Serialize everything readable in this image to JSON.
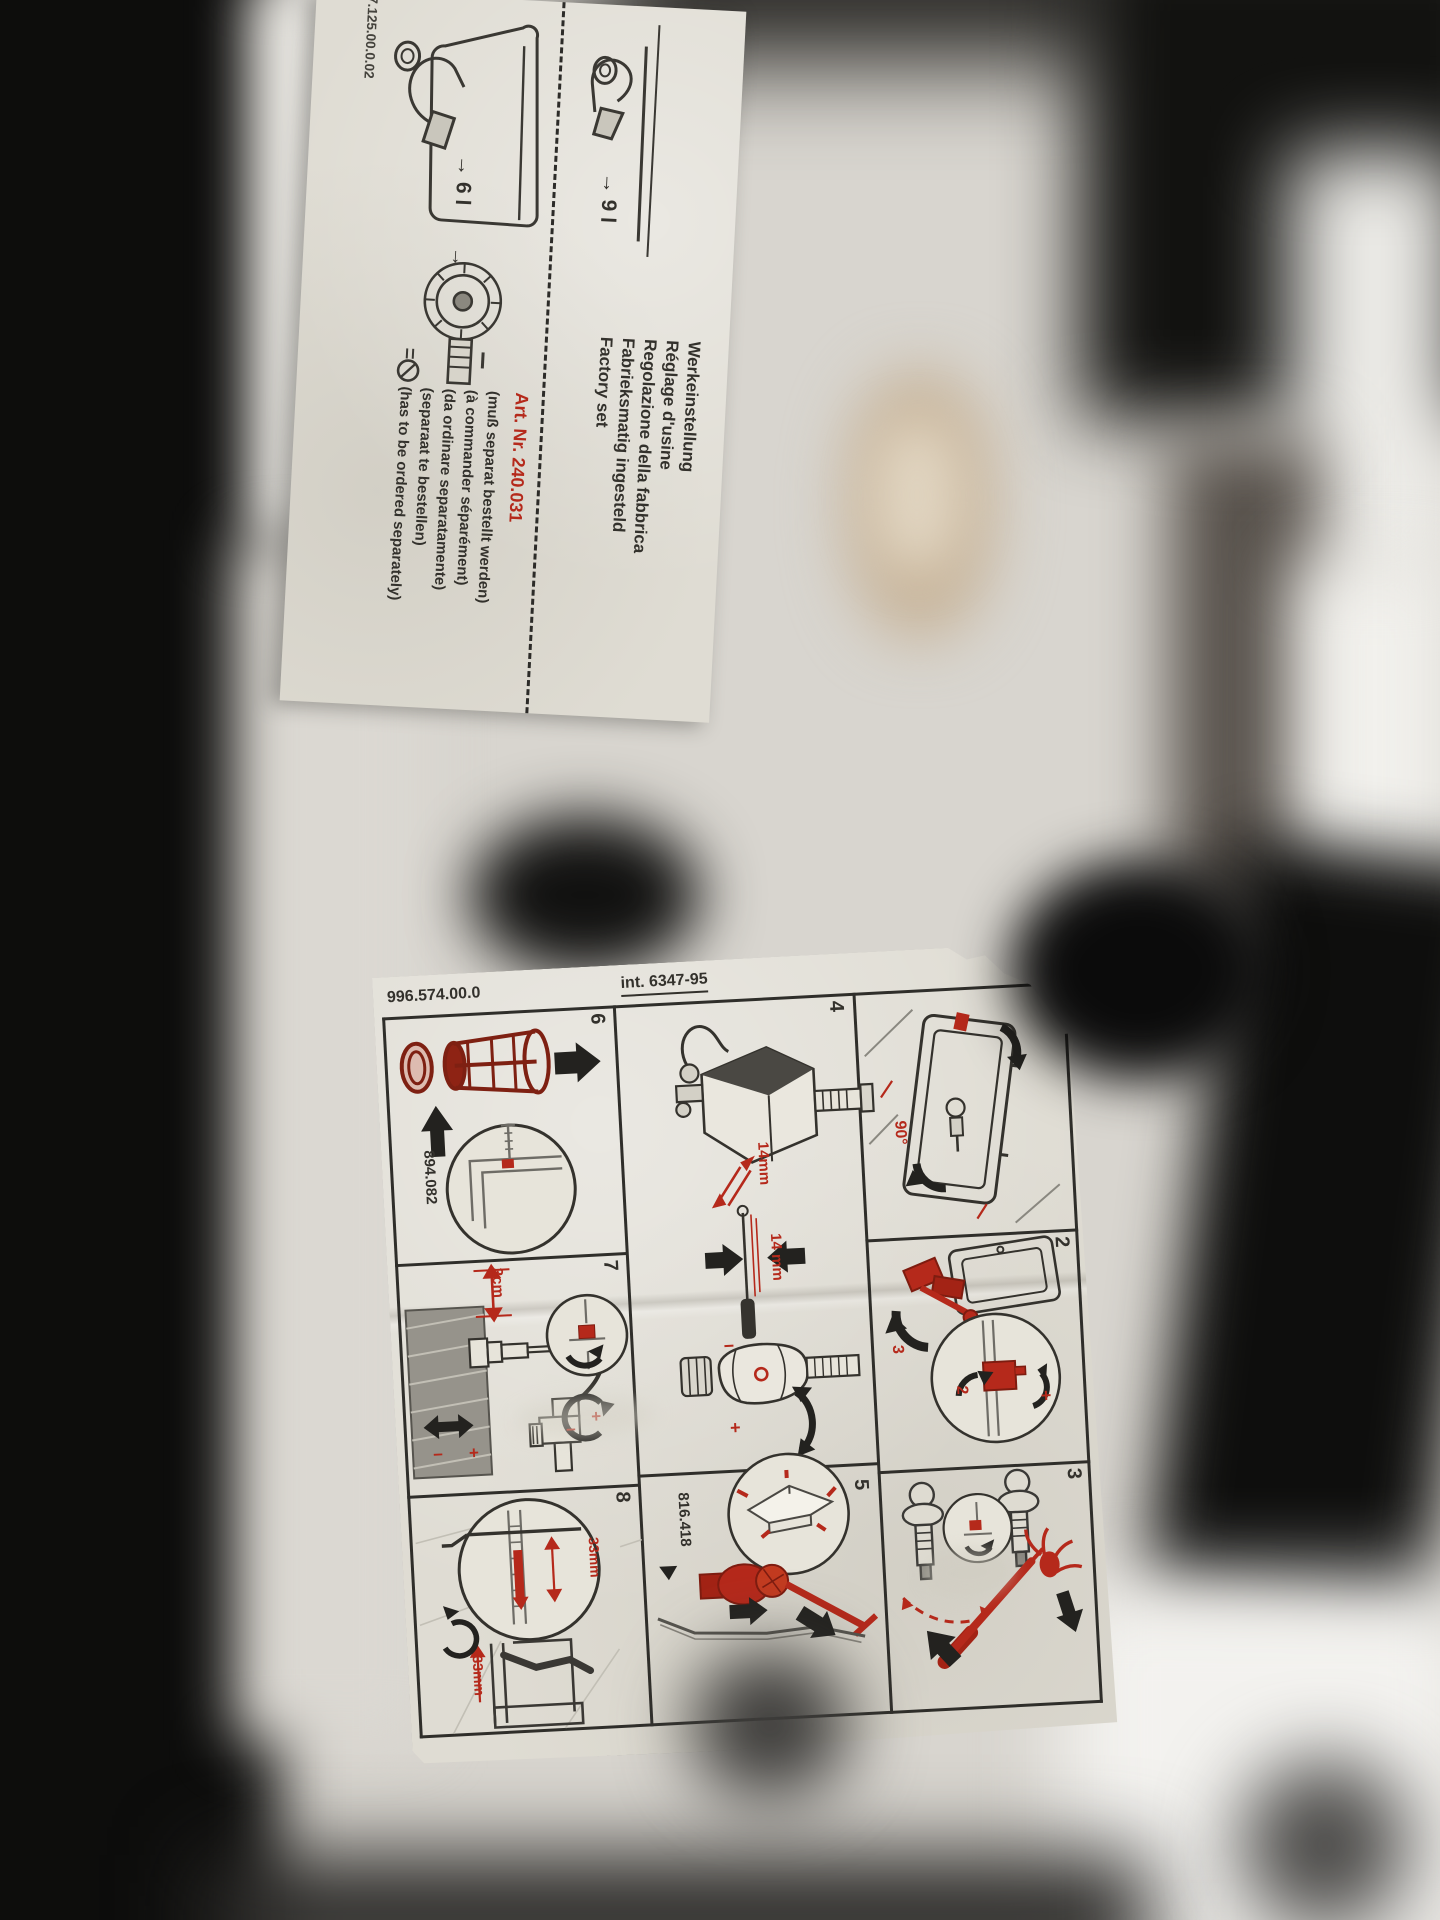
{
  "leaflet": {
    "form_number": "7.125.00.0.02",
    "titles": [
      "Werkeinstellung",
      "Réglage d'usine",
      "Regolazione della fabbrica",
      "Fabrieksmatig ingesteld",
      "Factory set"
    ],
    "art_nr": "Art. Nr. 240.031",
    "notes": [
      "(muß separat bestellt werden)",
      "(à commander séparément)",
      "(da ordinare separatamente)",
      "(separaat te bestellen)",
      "(has to be ordered separately)"
    ],
    "factory_volume": "→ 9 l",
    "reduced_volume": "→ 6 l",
    "turn_arrow": "→"
  },
  "sheet": {
    "doc_number": "996.574.00.0",
    "revision": "int. 6347-95",
    "panel_numbers": {
      "n2": "2",
      "n3": "3",
      "n4": "4",
      "n5": "5",
      "n6": "6",
      "n7": "7",
      "n8": "8"
    },
    "labels": {
      "basket_part": "894.082",
      "actuator_part": "816.418",
      "dim_top": "14mm",
      "dim_mid": "14 mm",
      "dim_depth": "3cm",
      "dim_rail": "33mm",
      "dim_rail2": "33mm",
      "angle": "90°",
      "step2": "2",
      "step3": "3",
      "plus": "+",
      "minus": "−",
      "plus2": "+",
      "minus2": "−",
      "plus3": "+",
      "minus3": "−",
      "plus4": "+"
    },
    "ink_colors": {
      "red": "#b5291b",
      "black": "#33312c"
    }
  }
}
